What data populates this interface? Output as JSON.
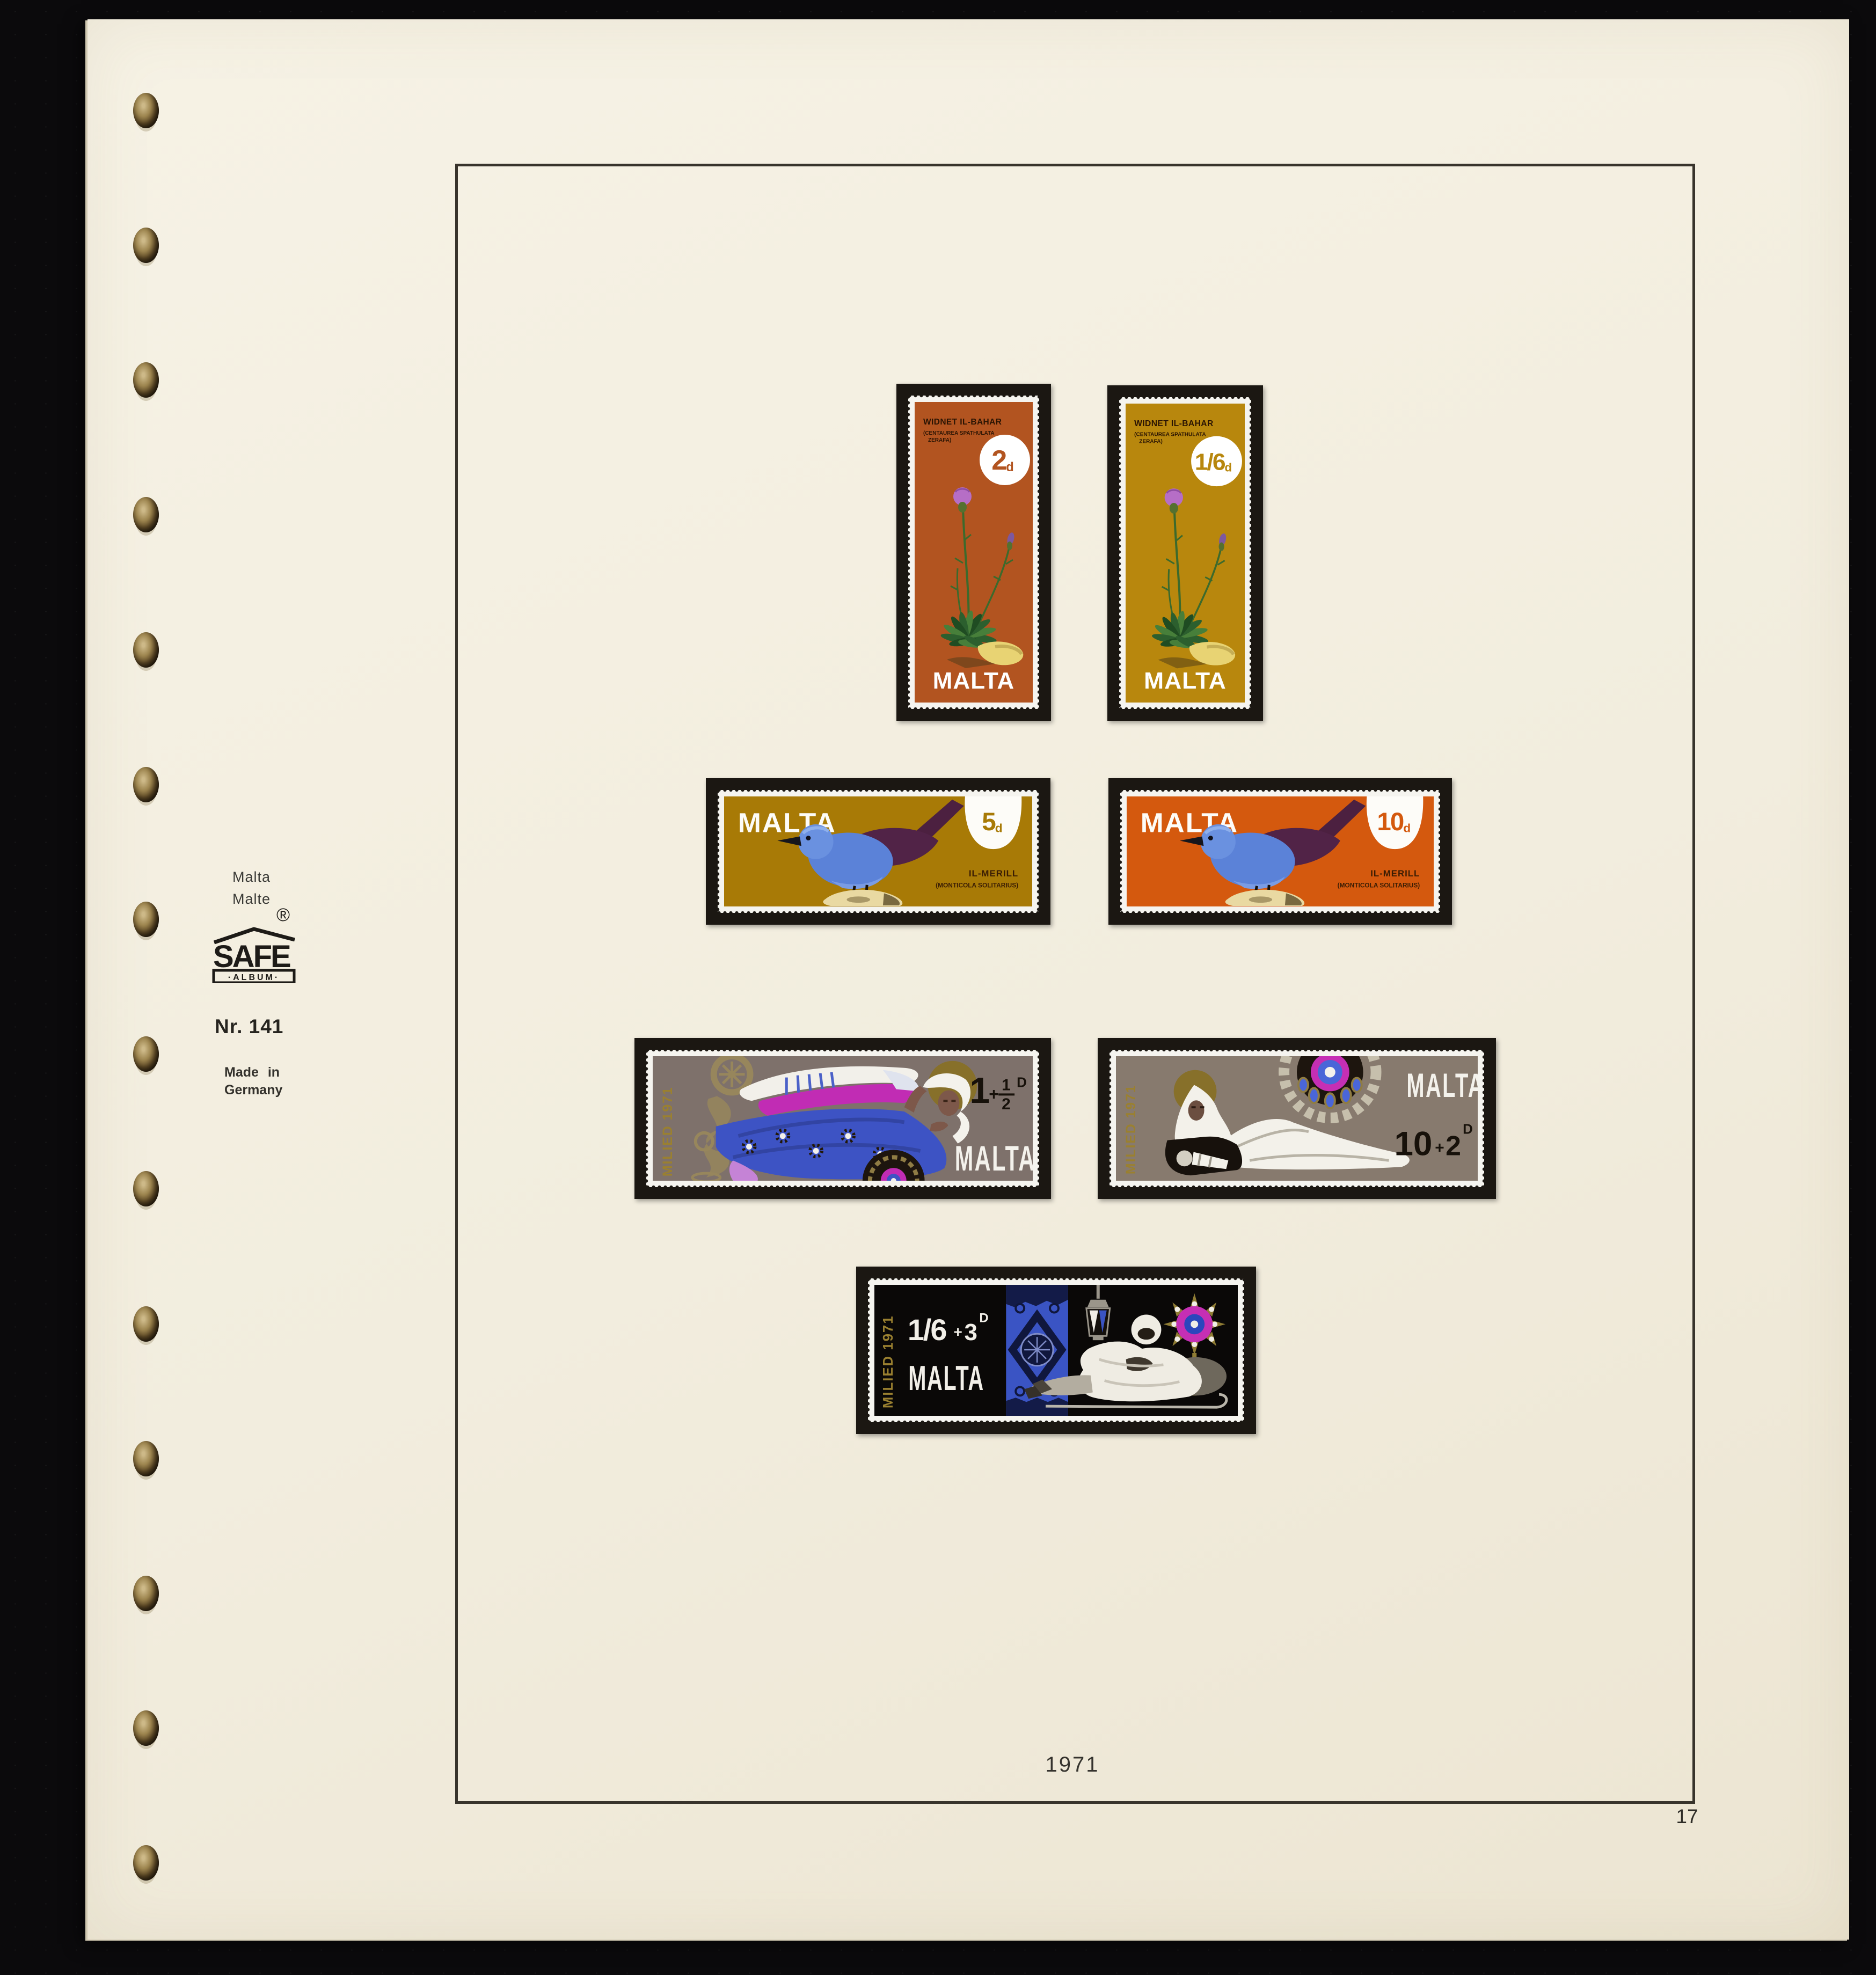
{
  "page": {
    "year_label": "1971",
    "page_number": "17",
    "paper_color": "#f2edde",
    "backdrop_color": "#0b0a0c",
    "frame_color": "#38342c"
  },
  "margin": {
    "country_line1": "Malta",
    "country_line2": "Malte",
    "brand": "SAFE",
    "brand_sub": "·ALBUM·",
    "registered": "®",
    "ref": "Nr. 141",
    "made_in_line1": "Made in",
    "made_in_line2": "Germany"
  },
  "stamps": {
    "flower_2d": {
      "title": "WIDNET IL-BAHAR",
      "latin1": "(CENTAUREA SPATHULATA",
      "latin2": "ZERAFA)",
      "value": "2",
      "unit": "d",
      "country": "MALTA",
      "bg": "#b25420"
    },
    "flower_1s6d": {
      "title": "WIDNET IL-BAHAR",
      "latin1": "(CENTAUREA SPATHULATA",
      "latin2": "ZERAFA)",
      "value": "1/6",
      "unit": "d",
      "country": "MALTA",
      "bg": "#b8870d"
    },
    "bird_5d": {
      "country": "MALTA",
      "value": "5",
      "unit": "d",
      "name": "IL-MERILL",
      "latin": "(MONTICOLA SOLITARIUS)",
      "bg": "#a87a06"
    },
    "bird_10d": {
      "country": "MALTA",
      "value": "10",
      "unit": "d",
      "name": "IL-MERILL",
      "latin": "(MONTICOLA SOLITARIUS)",
      "bg": "#d4590e"
    },
    "xmas_angel": {
      "issue": "MILIED 1971",
      "value_main": "1",
      "value_plus": "+",
      "frac_top": "1",
      "frac_bot": "2",
      "unit": "D",
      "country": "MALTA",
      "bg": "#7e716b"
    },
    "xmas_nativity": {
      "issue": "MILIED 1971",
      "value_big": "10",
      "value_plus": "+",
      "value_small": "2",
      "unit": "D",
      "country": "MALTA",
      "bg": "#877a6e"
    },
    "xmas_shepherd": {
      "issue": "MILIED 1971",
      "value_big": "1/6",
      "value_plus": "+",
      "value_small": "3",
      "unit": "D",
      "country": "MALTA",
      "bg": "#0a0807"
    }
  }
}
